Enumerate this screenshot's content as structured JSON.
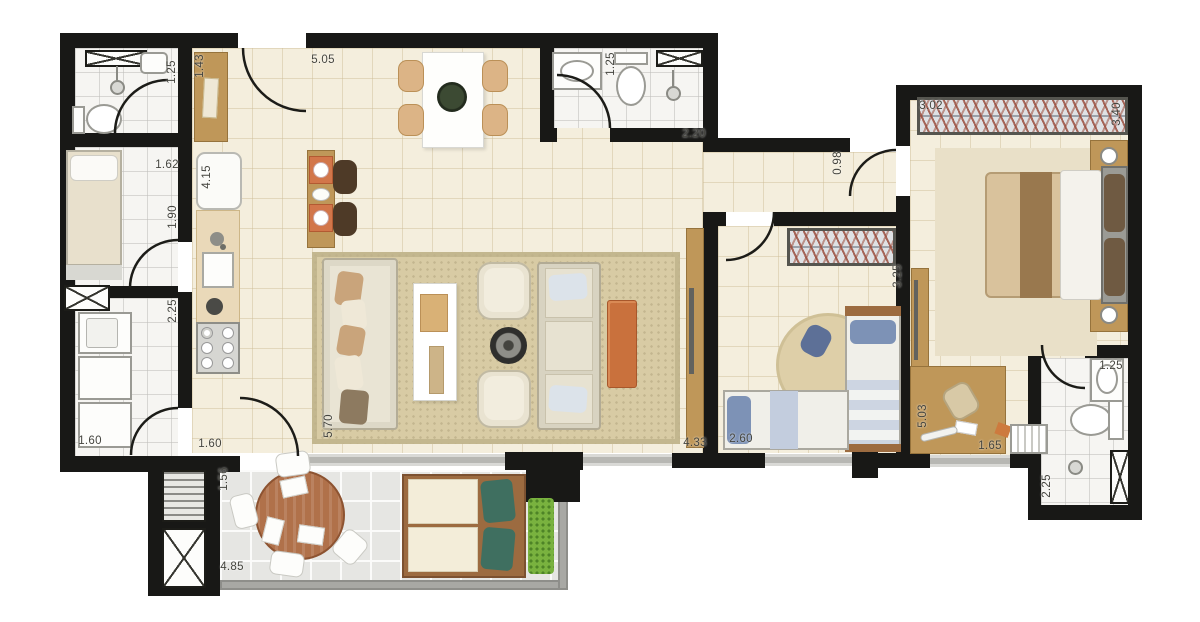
{
  "plan": {
    "type": "apartment-floor-plan",
    "colors": {
      "wall": "#181816",
      "floor": "#f4eedd",
      "wet_floor": "#f6f5f2",
      "balcony_floor": "#e6e6e3",
      "rug": "#d8cba4",
      "wood": "#bf9759",
      "orange": "#c9713d",
      "kids_blue": "#7d92b6",
      "plant": "#79b23f",
      "teal": "#3f6f60",
      "label": "#45453f"
    },
    "dimensions": [
      {
        "id": "service-bath-width",
        "text": "1.25",
        "x": 172,
        "y": 72,
        "v": 1
      },
      {
        "id": "entry-cabinet",
        "text": "1.43",
        "x": 200,
        "y": 66,
        "v": 1
      },
      {
        "id": "living-width",
        "text": "5.05",
        "x": 323,
        "y": 60,
        "v": 0
      },
      {
        "id": "bathroom2-sink",
        "text": "1.25",
        "x": 611,
        "y": 64,
        "v": 1
      },
      {
        "id": "bathroom2-width",
        "text": "2.20",
        "x": 694,
        "y": 134,
        "v": 0
      },
      {
        "id": "hall-width",
        "text": "0.98",
        "x": 838,
        "y": 163,
        "v": 1
      },
      {
        "id": "master-wardrobe",
        "text": "3.02",
        "x": 931,
        "y": 106,
        "v": 0
      },
      {
        "id": "master-depth",
        "text": "3.40",
        "x": 1117,
        "y": 114,
        "v": 1
      },
      {
        "id": "maid-room-width",
        "text": "1.62",
        "x": 167,
        "y": 165,
        "v": 0
      },
      {
        "id": "kitchen-depth",
        "text": "4.15",
        "x": 207,
        "y": 177,
        "v": 1
      },
      {
        "id": "maid-room-depth",
        "text": "1.90",
        "x": 173,
        "y": 217,
        "v": 1
      },
      {
        "id": "laundry-depth",
        "text": "2.25",
        "x": 173,
        "y": 311,
        "v": 1
      },
      {
        "id": "kids-wardrobe",
        "text": "3.25",
        "x": 898,
        "y": 276,
        "v": 1
      },
      {
        "id": "living-depth",
        "text": "5.70",
        "x": 329,
        "y": 426,
        "v": 1
      },
      {
        "id": "living-length",
        "text": "4.33",
        "x": 695,
        "y": 443,
        "v": 0
      },
      {
        "id": "kids-room-width",
        "text": "2.60",
        "x": 741,
        "y": 439,
        "v": 0
      },
      {
        "id": "master-length",
        "text": "5.03",
        "x": 923,
        "y": 416,
        "v": 1
      },
      {
        "id": "master-desk",
        "text": "1.65",
        "x": 990,
        "y": 446,
        "v": 0
      },
      {
        "id": "ensuite-sink",
        "text": "1.25",
        "x": 1111,
        "y": 366,
        "v": 0
      },
      {
        "id": "ensuite-depth",
        "text": "2.25",
        "x": 1047,
        "y": 486,
        "v": 1
      },
      {
        "id": "laundry-width",
        "text": "1.60",
        "x": 90,
        "y": 441,
        "v": 0
      },
      {
        "id": "kitchen-hall-width",
        "text": "1.60",
        "x": 210,
        "y": 444,
        "v": 0
      },
      {
        "id": "balcony-depth",
        "text": "1.56",
        "x": 224,
        "y": 479,
        "v": 1
      },
      {
        "id": "balcony-width",
        "text": "4.85",
        "x": 232,
        "y": 567,
        "v": 0
      }
    ]
  }
}
